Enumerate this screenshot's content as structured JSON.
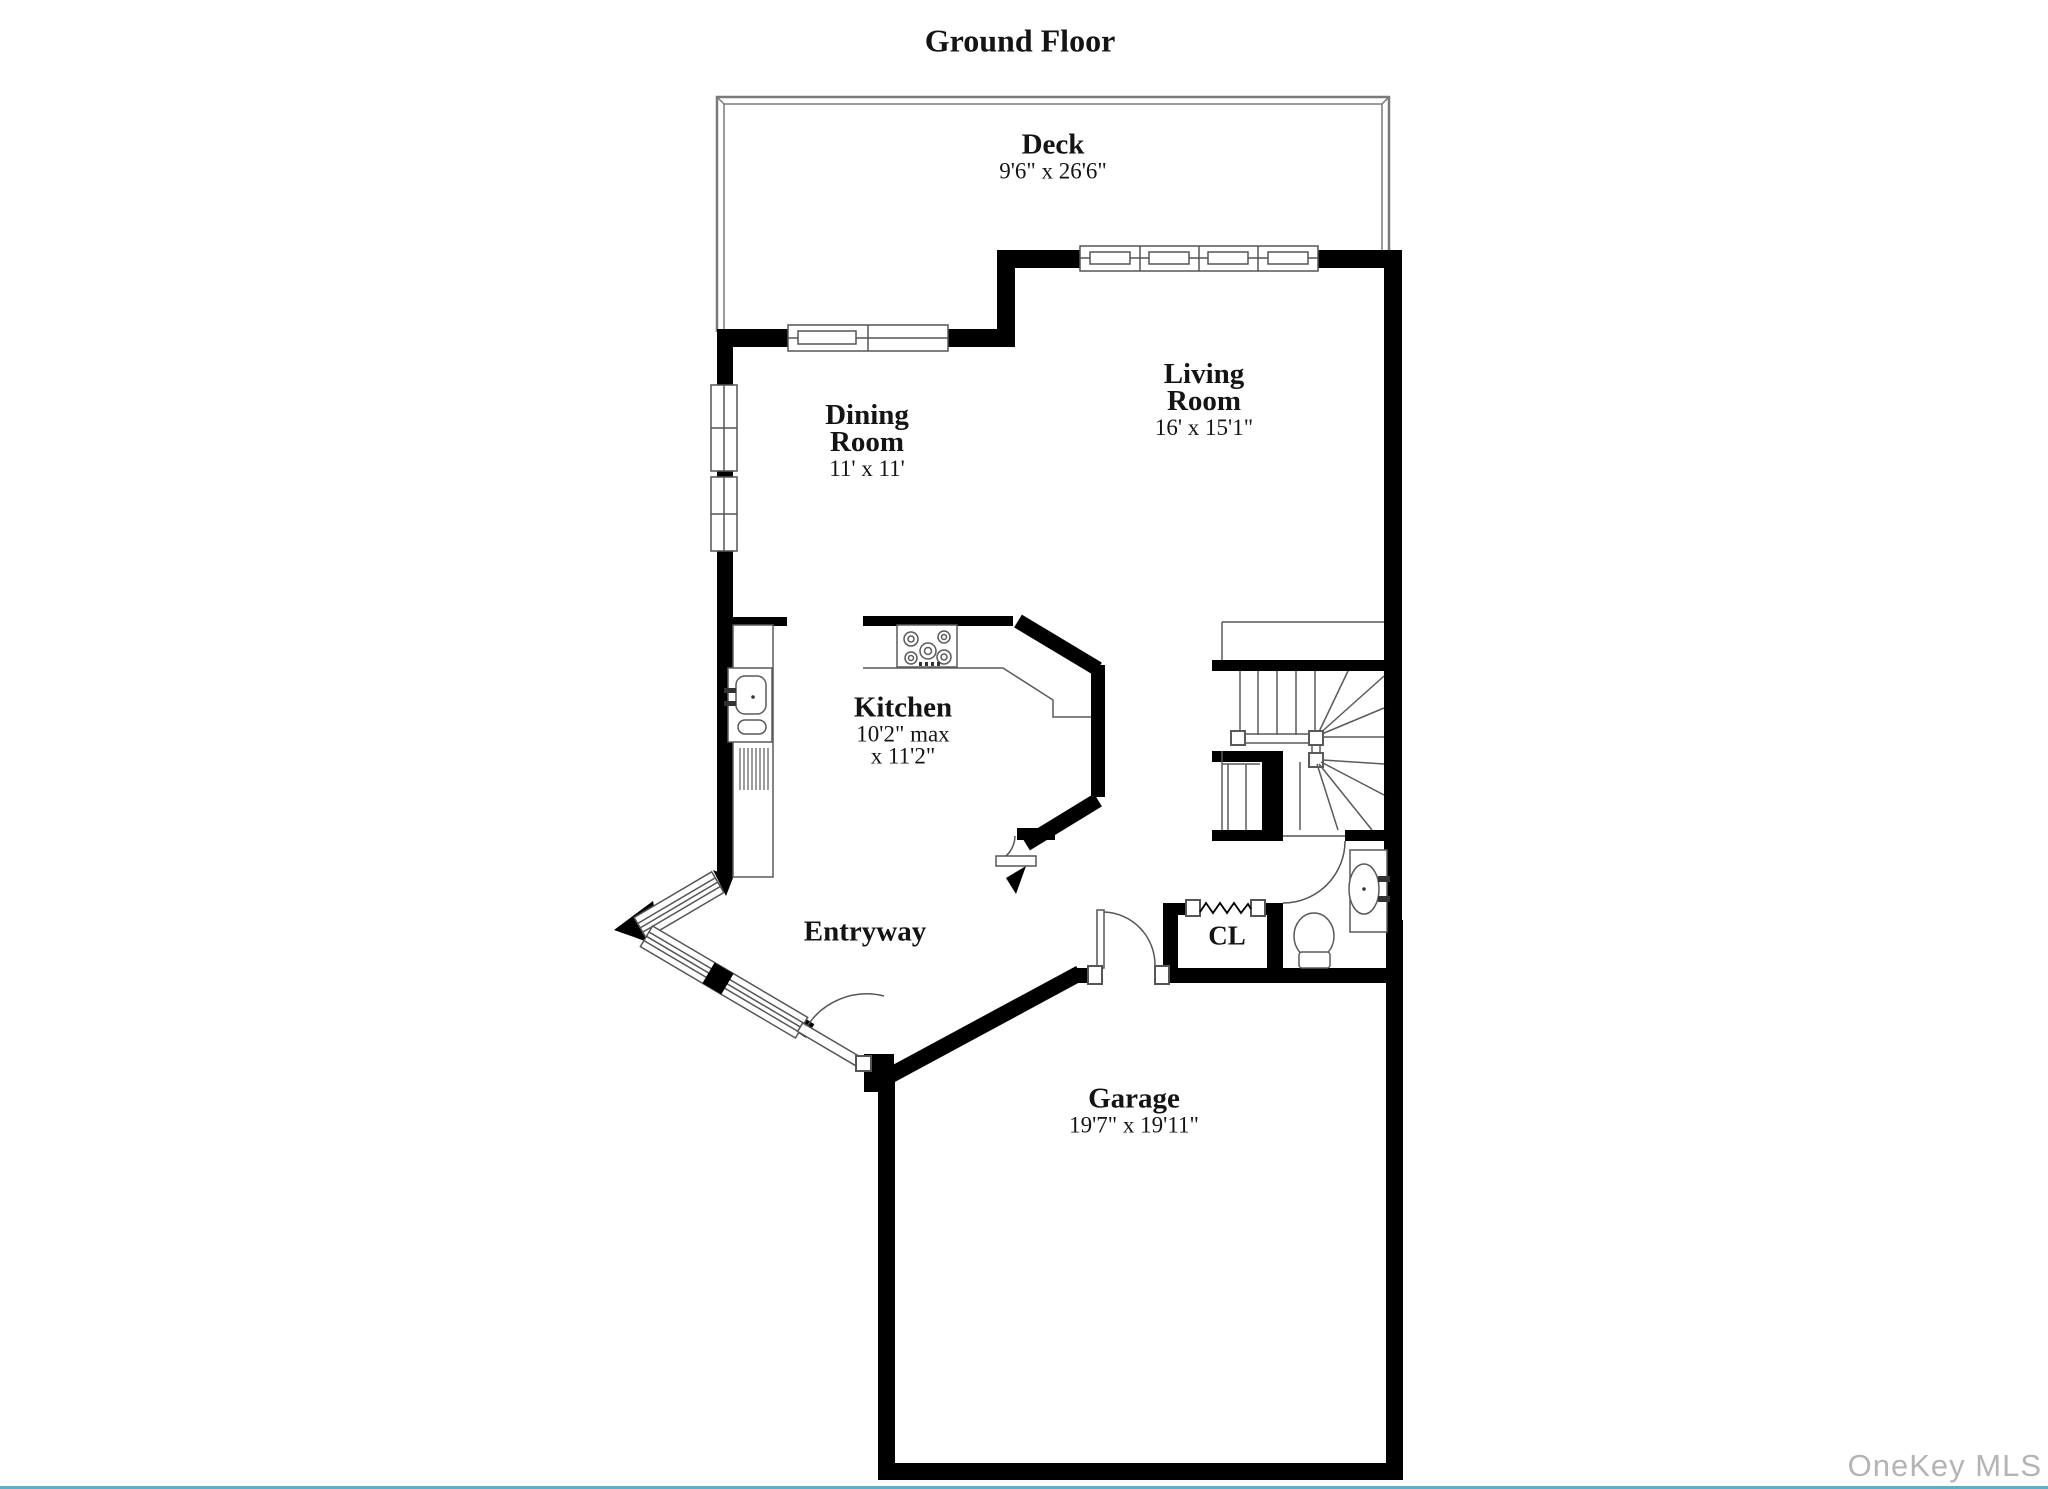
{
  "page": {
    "title": "Ground Floor",
    "watermark": "OneKey MLS",
    "accent_color": "#5faec9",
    "wall_color": "#000000",
    "watermark_color": "#b4b4b4"
  },
  "rooms": {
    "deck": {
      "name": "Deck",
      "dims": "9'6\" x 26'6\""
    },
    "dining": {
      "name": "Dining\nRoom",
      "dims": "11' x 11'"
    },
    "living": {
      "name": "Living\nRoom",
      "dims": "16' x 15'1\""
    },
    "kitchen": {
      "name": "Kitchen",
      "dims": "10'2\" max\nx 11'2\""
    },
    "entryway": {
      "name": "Entryway",
      "dims": ""
    },
    "closet": {
      "name": "CL",
      "dims": ""
    },
    "garage": {
      "name": "Garage",
      "dims": "19'7\" x 19'11\""
    }
  },
  "symbols": {
    "stove": "stove-burners-icon",
    "kitchen_sink": "kitchen-sink-icon",
    "dishwasher": "dishwasher-icon",
    "toilet": "toilet-icon",
    "vanity_sink": "bathroom-sink-icon",
    "closet_rod": "closet-rod-zigzag-icon",
    "stairs": "staircase-symbol",
    "door": "door-swing-arc-symbol",
    "window": "window-glazing-symbol"
  }
}
